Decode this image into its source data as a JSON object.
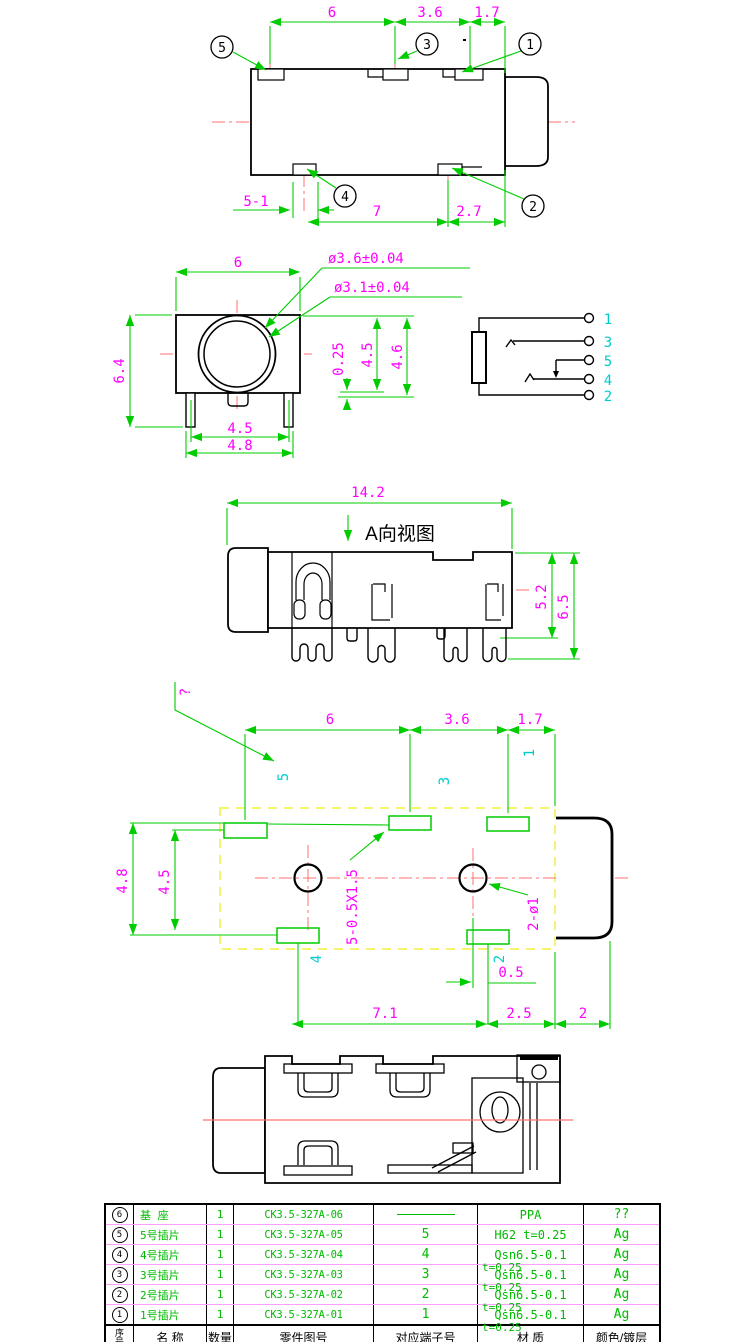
{
  "colors": {
    "outline": "#000000",
    "dimension_line": "#00cc00",
    "dimension_text": "#ff00ff",
    "terminal_text": "#00cccc",
    "centerline": "#ff7070",
    "pcb_outline_dash": "#f2f25a",
    "table_text": "#00bb00",
    "table_row_divider": "#ff9eff"
  },
  "v1": {
    "dims_top": [
      "6",
      "3.6",
      "1.7"
    ],
    "dims_bottom": [
      "5-1",
      "7",
      "2.7"
    ],
    "callouts": [
      "5",
      "3",
      "1",
      "4",
      "2"
    ]
  },
  "v2": {
    "w": "6",
    "h": "6.4",
    "pins_inner": "4.5",
    "pins_outer": "4.8",
    "dia_outer": "ø3.6±0.04",
    "dia_inner": "ø3.1±0.04",
    "offset": "0.25",
    "h1": "4.5",
    "h2": "4.6"
  },
  "sch": {
    "terminals": [
      "1",
      "3",
      "5",
      "4",
      "2"
    ]
  },
  "v3": {
    "title": "A向视图",
    "w": "14.2",
    "h1": "5.2",
    "h2": "6.5"
  },
  "v4": {
    "dims_top": [
      "6",
      "3.6",
      "1.7"
    ],
    "left_outer": "4.8",
    "left_inner": "4.5",
    "q": "?",
    "pads": [
      "5",
      "3",
      "1",
      "4",
      "2"
    ],
    "slot": "5-0.5X1.5",
    "hole": "2-ø1",
    "offset": "0.5",
    "dims_bottom": [
      "7.1",
      "2.5",
      "2"
    ]
  },
  "table": {
    "headers": [
      "序号",
      "名 称",
      "数量",
      "零件图号",
      "对应端子号",
      "材 质",
      "颜色/镀层"
    ],
    "rows": [
      {
        "no": "6",
        "name": "基 座",
        "qty": "1",
        "part": "CK3.5-327A-06",
        "terminal": "",
        "material": "PPA",
        "material2": "",
        "finish": "??"
      },
      {
        "no": "5",
        "name": "5号插片",
        "qty": "1",
        "part": "CK3.5-327A-05",
        "terminal": "5",
        "material": "H62  t=0.25",
        "material2": "",
        "finish": "Ag"
      },
      {
        "no": "4",
        "name": "4号插片",
        "qty": "1",
        "part": "CK3.5-327A-04",
        "terminal": "4",
        "material": "Qsn6.5-0.1",
        "material2": "t=0.25",
        "finish": "Ag"
      },
      {
        "no": "3",
        "name": "3号插片",
        "qty": "1",
        "part": "CK3.5-327A-03",
        "terminal": "3",
        "material": "Qsn6.5-0.1",
        "material2": "t=0.25",
        "finish": "Ag"
      },
      {
        "no": "2",
        "name": "2号插片",
        "qty": "1",
        "part": "CK3.5-327A-02",
        "terminal": "2",
        "material": "Qsn6.5-0.1",
        "material2": "t=0.25",
        "finish": "Ag"
      },
      {
        "no": "1",
        "name": "1号插片",
        "qty": "1",
        "part": "CK3.5-327A-01",
        "terminal": "1",
        "material": "Qsn6.5-0.1",
        "material2": "t=0.25",
        "finish": "Ag"
      }
    ]
  }
}
